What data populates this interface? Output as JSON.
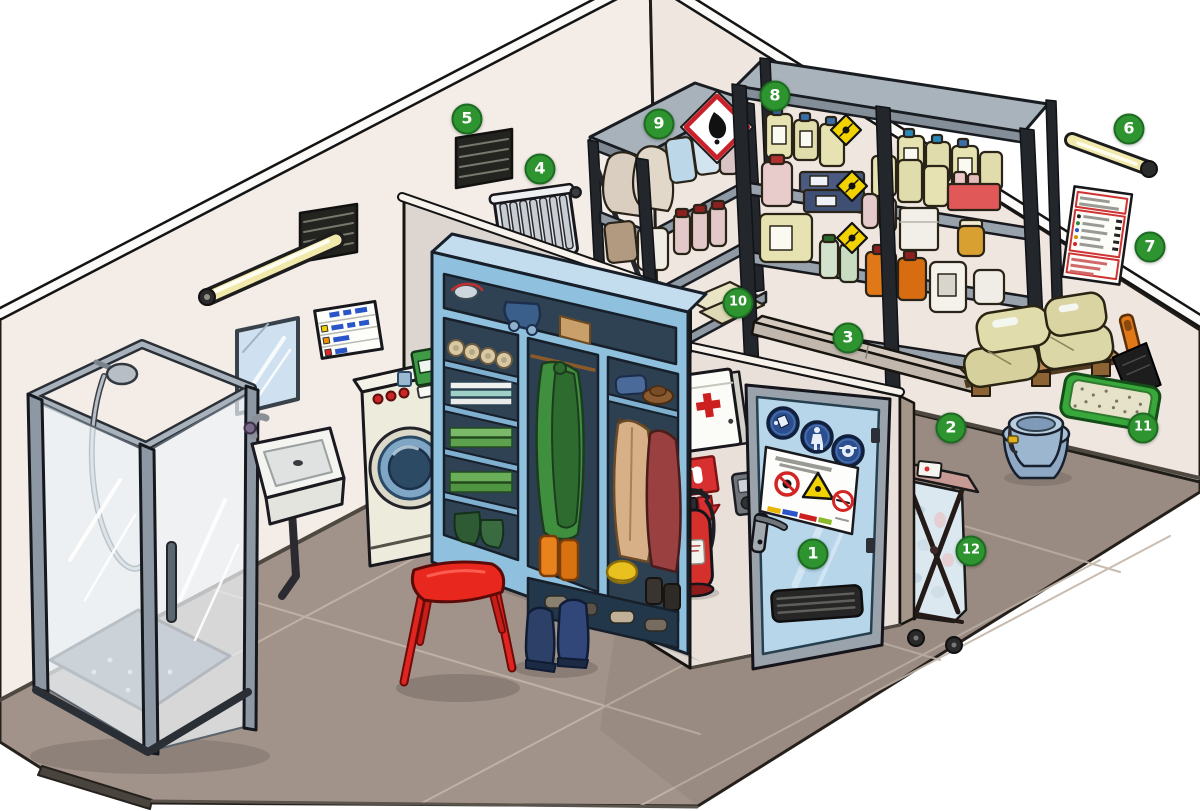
{
  "markers": [
    {
      "label": "1",
      "name": "entrance-door"
    },
    {
      "label": "2",
      "label_area": "floor",
      "name": "pallet-storage"
    },
    {
      "label": "3",
      "name": "retention-sill"
    },
    {
      "label": "4",
      "name": "radiator"
    },
    {
      "label": "5",
      "name": "ventilation-grille"
    },
    {
      "label": "6",
      "name": "strip-light"
    },
    {
      "label": "7",
      "name": "emergency-notice"
    },
    {
      "label": "8",
      "name": "chemical-shelf-large"
    },
    {
      "label": "9",
      "name": "chemical-shelf-small"
    },
    {
      "label": "10",
      "name": "lower-shelf-tray"
    },
    {
      "label": "11",
      "name": "absorbent-tray"
    },
    {
      "label": "12",
      "name": "laundry-cart"
    }
  ],
  "colors": {
    "hotspot_green": "#2e9430",
    "hotspot_border": "#1d6b21",
    "wall_left": "#f3ece7",
    "wall_right": "#efe6e0",
    "door_wall": "#e9e0d9",
    "partition": "#ddd6d0",
    "floor": "#a2938a",
    "door_blue": "#b7d6ea",
    "wardrobe_blue": "#8fc0dd",
    "safety_sign_blue": "#2b4f8e",
    "warning_yellow": "#f2d200",
    "hazard_red": "#d42a2a",
    "tray_green": "#39a83b"
  }
}
